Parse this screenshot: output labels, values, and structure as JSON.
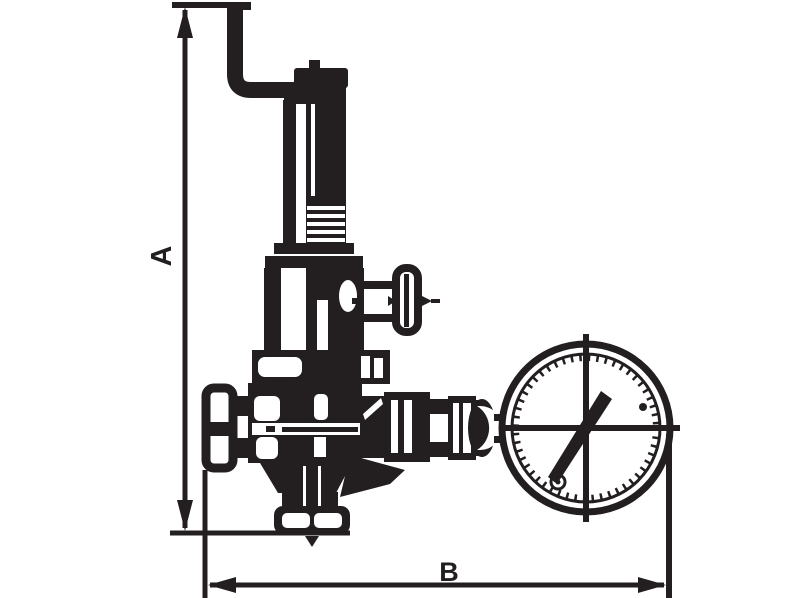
{
  "figure": {
    "dimension_labels": {
      "a": "A",
      "b": "B"
    },
    "colors": {
      "ink": "#231f20",
      "paper": "#ffffff"
    },
    "gauge": {
      "needle_angle_deg": 55,
      "screw_dots": 2
    },
    "components": [
      "discharge-pipe",
      "adjusting-cap",
      "spring-bonnet",
      "side-branch-tee-handle",
      "valve-body",
      "inlet-union",
      "gauge-connection",
      "pressure-gauge",
      "bottom-outlet-flange",
      "dimension-a",
      "dimension-b"
    ]
  }
}
